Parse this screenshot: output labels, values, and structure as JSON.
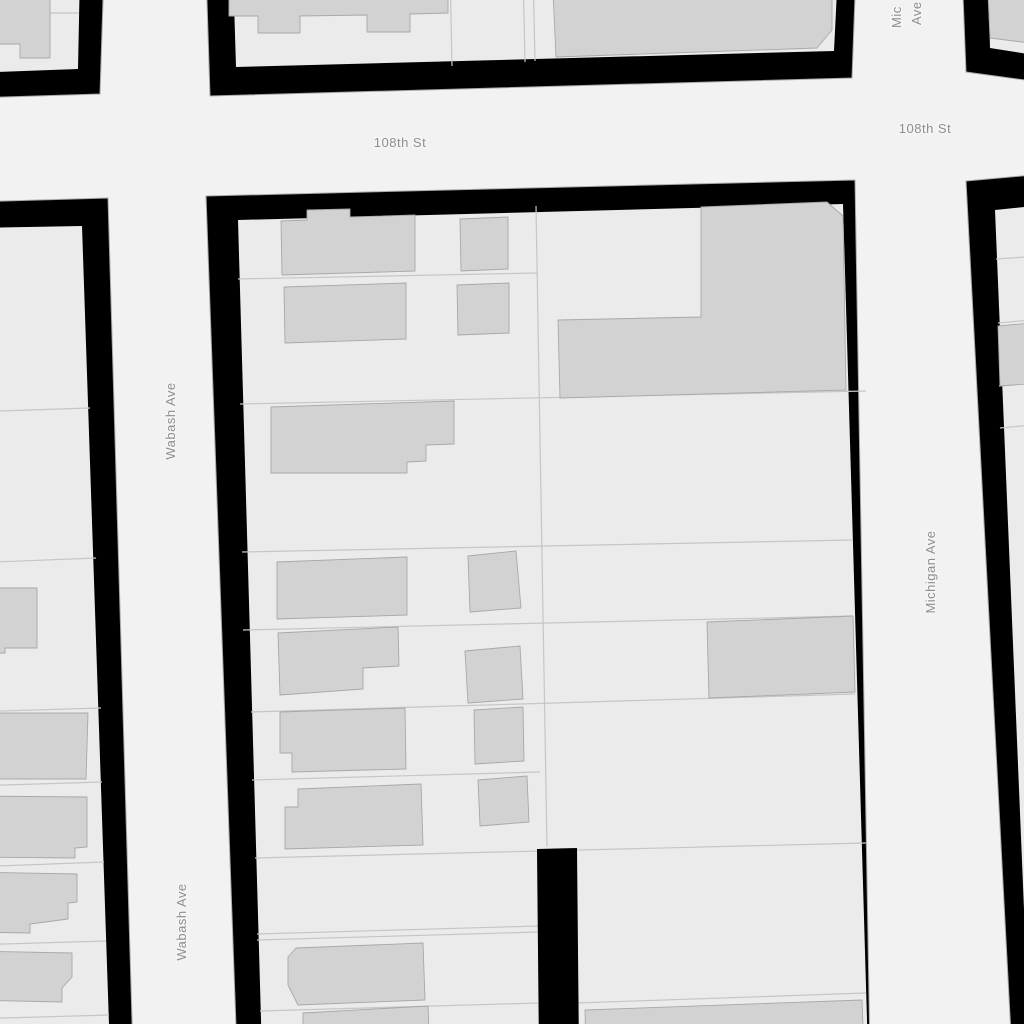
{
  "map": {
    "colors": {
      "street": "#f2f2f2",
      "block_fill": "#ebebeb",
      "block_border": "#000000",
      "block_outline": "#a9a9a9",
      "building_fill": "#d2d2d2",
      "building_stroke": "#a8a8a8",
      "parcel_line": "#c6c6c6",
      "label": "#8f8f8f",
      "label_halo": "#f5f5f5"
    },
    "labels": [
      {
        "name": "street-label-108th-st-west",
        "text": "108th St",
        "x": 400,
        "y": 147,
        "rotate": 0,
        "anchor": "middle"
      },
      {
        "name": "street-label-108th-st-east",
        "text": "108th St",
        "x": 925,
        "y": 133,
        "rotate": 0,
        "anchor": "middle"
      },
      {
        "name": "street-label-wabash-ave-north",
        "text": "Wabash Ave",
        "x": 175,
        "y": 421,
        "rotate": -90,
        "anchor": "middle"
      },
      {
        "name": "street-label-wabash-ave-south",
        "text": "Wabash Ave",
        "x": 186,
        "y": 922,
        "rotate": -90,
        "anchor": "middle"
      },
      {
        "name": "street-label-michigan-ave",
        "text": "Michigan Ave",
        "x": 935,
        "y": 572,
        "rotate": -90,
        "anchor": "middle"
      },
      {
        "name": "street-label-michigan-ave-top-line1",
        "text": "Mic",
        "x": 901,
        "y": 28,
        "rotate": -90,
        "anchor": "start"
      },
      {
        "name": "street-label-michigan-ave-top-line2",
        "text": "Ave",
        "x": 921,
        "y": 25,
        "rotate": -90,
        "anchor": "start"
      }
    ],
    "blocks": [
      {
        "name": "block-northwest",
        "outer": [
          [
            -30,
            -30
          ],
          [
            104,
            -30
          ],
          [
            100,
            94
          ],
          [
            -30,
            98
          ]
        ],
        "inner": [
          [
            -30,
            -30
          ],
          [
            80,
            -30
          ],
          [
            78,
            69
          ],
          [
            -30,
            73
          ]
        ],
        "parcel_lines": [
          [
            50,
            13,
            79,
            13
          ]
        ],
        "buildings": [
          [
            [
              -30,
              -30
            ],
            [
              50,
              -30
            ],
            [
              50,
              58
            ],
            [
              20,
              58
            ],
            [
              20,
              44
            ],
            [
              -30,
              44
            ]
          ]
        ]
      },
      {
        "name": "block-north",
        "outer": [
          [
            206,
            -30
          ],
          [
            856,
            -30
          ],
          [
            852,
            78
          ],
          [
            210,
            96
          ]
        ],
        "inner": [
          [
            233,
            -30
          ],
          [
            838,
            -30
          ],
          [
            834,
            51
          ],
          [
            236,
            67
          ]
        ],
        "parcel_lines": [
          [
            450,
            -30,
            452,
            66
          ],
          [
            523,
            -30,
            525,
            62
          ],
          [
            533,
            -30,
            535,
            61
          ]
        ],
        "buildings": [
          [
            [
              229,
              -30
            ],
            [
              448,
              -30
            ],
            [
              448,
              13
            ],
            [
              410,
              14
            ],
            [
              410,
              32
            ],
            [
              367,
              32
            ],
            [
              367,
              15
            ],
            [
              300,
              16
            ],
            [
              300,
              33
            ],
            [
              258,
              33
            ],
            [
              258,
              16
            ],
            [
              229,
              16
            ]
          ],
          [
            [
              552,
              -30
            ],
            [
              832,
              -30
            ],
            [
              832,
              30
            ],
            [
              817,
              48
            ],
            [
              556,
              57
            ]
          ]
        ]
      },
      {
        "name": "block-northeast",
        "outer": [
          [
            962,
            -30
          ],
          [
            1054,
            -30
          ],
          [
            1054,
            84
          ],
          [
            966,
            72
          ]
        ],
        "inner": [
          [
            988,
            -30
          ],
          [
            1054,
            -30
          ],
          [
            1054,
            58
          ],
          [
            990,
            48
          ]
        ],
        "parcel_lines": [],
        "buildings": [
          [
            [
              987,
              -30
            ],
            [
              1054,
              -30
            ],
            [
              1054,
              46
            ],
            [
              990,
              38
            ]
          ]
        ]
      },
      {
        "name": "block-east",
        "outer": [
          [
            966,
            181
          ],
          [
            1054,
            173
          ],
          [
            1054,
            1054
          ],
          [
            1012,
            1054
          ]
        ],
        "inner": [
          [
            995,
            210
          ],
          [
            1054,
            204
          ],
          [
            1054,
            1054
          ],
          [
            1030,
            1054
          ]
        ],
        "parcel_lines": [
          [
            996,
            259,
            1054,
            255
          ],
          [
            998,
            323,
            1054,
            318
          ],
          [
            999,
            386,
            1054,
            381
          ],
          [
            1000,
            428,
            1054,
            423
          ]
        ],
        "buildings": [
          [
            [
              998,
              326
            ],
            [
              1054,
              321
            ],
            [
              1054,
              382
            ],
            [
              1000,
              386
            ]
          ]
        ]
      },
      {
        "name": "block-west",
        "outer": [
          [
            -30,
            202
          ],
          [
            108,
            198
          ],
          [
            133,
            1054
          ],
          [
            -30,
            1054
          ]
        ],
        "inner": [
          [
            -30,
            228
          ],
          [
            82,
            226
          ],
          [
            110,
            1054
          ],
          [
            -30,
            1054
          ]
        ],
        "parcel_lines": [
          [
            -30,
            412,
            90,
            408
          ],
          [
            -30,
            563,
            96,
            558
          ],
          [
            -30,
            712,
            101,
            708
          ],
          [
            -30,
            786,
            102,
            782
          ],
          [
            -30,
            867,
            104,
            862
          ],
          [
            -30,
            945,
            106,
            941
          ],
          [
            -30,
            1019,
            109,
            1015
          ]
        ],
        "buildings": [
          [
            [
              -30,
              588
            ],
            [
              37,
              588
            ],
            [
              37,
              648
            ],
            [
              5,
              648
            ],
            [
              5,
              653
            ],
            [
              -30,
              653
            ]
          ],
          [
            [
              -30,
              713
            ],
            [
              88,
              713
            ],
            [
              86,
              779
            ],
            [
              -30,
              779
            ]
          ],
          [
            [
              -30,
              796
            ],
            [
              87,
              797
            ],
            [
              87,
              847
            ],
            [
              75,
              848
            ],
            [
              75,
              858
            ],
            [
              -30,
              857
            ]
          ],
          [
            [
              -30,
              872
            ],
            [
              77,
              874
            ],
            [
              77,
              902
            ],
            [
              68,
              903
            ],
            [
              68,
              919
            ],
            [
              30,
              924
            ],
            [
              30,
              933
            ],
            [
              -30,
              932
            ]
          ],
          [
            [
              -30,
              951
            ],
            [
              72,
              953
            ],
            [
              72,
              977
            ],
            [
              62,
              988
            ],
            [
              62,
              1002
            ],
            [
              -30,
              1000
            ]
          ]
        ]
      },
      {
        "name": "block-center",
        "outer": [
          [
            206,
            196
          ],
          [
            855,
            180
          ],
          [
            870,
            1054
          ],
          [
            237,
            1054
          ]
        ],
        "inner": [
          [
            238,
            220
          ],
          [
            843,
            204
          ],
          [
            868,
            1054
          ],
          [
            262,
            1054
          ]
        ],
        "parcel_lines": [
          [
            238,
            279,
            537,
            273
          ],
          [
            240,
            404,
            866,
            391
          ],
          [
            242,
            552,
            852,
            540
          ],
          [
            243,
            630,
            852,
            616
          ],
          [
            251,
            712,
            855,
            694
          ],
          [
            252,
            780,
            540,
            772
          ],
          [
            255,
            858,
            866,
            843
          ],
          [
            257,
            934,
            538,
            926
          ],
          [
            257,
            940,
            538,
            932
          ],
          [
            260,
            1011,
            538,
            1003
          ],
          [
            577,
            1003,
            866,
            993
          ],
          [
            536,
            206,
            547,
            847
          ]
        ],
        "buildings": [
          [
            [
              281,
              221
            ],
            [
              307,
              220
            ],
            [
              307,
              210
            ],
            [
              350,
              209
            ],
            [
              350,
              217
            ],
            [
              415,
              215
            ],
            [
              415,
              271
            ],
            [
              282,
              275
            ]
          ],
          [
            [
              460,
              219
            ],
            [
              508,
              217
            ],
            [
              508,
              269
            ],
            [
              461,
              271
            ]
          ],
          [
            [
              284,
              287
            ],
            [
              406,
              283
            ],
            [
              406,
              339
            ],
            [
              285,
              343
            ]
          ],
          [
            [
              457,
              285
            ],
            [
              509,
              283
            ],
            [
              509,
              333
            ],
            [
              458,
              335
            ]
          ],
          [
            [
              271,
              407
            ],
            [
              454,
              401
            ],
            [
              454,
              444
            ],
            [
              426,
              445
            ],
            [
              426,
              461
            ],
            [
              407,
              462
            ],
            [
              407,
              473
            ],
            [
              271,
              473
            ]
          ],
          [
            [
              277,
              562
            ],
            [
              407,
              557
            ],
            [
              407,
              615
            ],
            [
              277,
              619
            ]
          ],
          [
            [
              468,
              556
            ],
            [
              516,
              551
            ],
            [
              521,
              608
            ],
            [
              470,
              612
            ]
          ],
          [
            [
              278,
              633
            ],
            [
              398,
              627
            ],
            [
              399,
              666
            ],
            [
              363,
              668
            ],
            [
              363,
              689
            ],
            [
              280,
              695
            ]
          ],
          [
            [
              465,
              651
            ],
            [
              520,
              646
            ],
            [
              523,
              699
            ],
            [
              468,
              703
            ]
          ],
          [
            [
              280,
              712
            ],
            [
              405,
              708
            ],
            [
              406,
              769
            ],
            [
              292,
              772
            ],
            [
              292,
              753
            ],
            [
              280,
              753
            ]
          ],
          [
            [
              474,
              710
            ],
            [
              523,
              707
            ],
            [
              524,
              761
            ],
            [
              475,
              764
            ]
          ],
          [
            [
              298,
              789
            ],
            [
              421,
              784
            ],
            [
              423,
              845
            ],
            [
              285,
              849
            ],
            [
              285,
              807
            ],
            [
              298,
              807
            ]
          ],
          [
            [
              478,
              780
            ],
            [
              527,
              776
            ],
            [
              529,
              822
            ],
            [
              480,
              826
            ]
          ],
          [
            [
              296,
              948
            ],
            [
              423,
              943
            ],
            [
              425,
              1000
            ],
            [
              298,
              1005
            ],
            [
              288,
              985
            ],
            [
              288,
              957
            ]
          ],
          [
            [
              303,
              1013
            ],
            [
              428,
              1006
            ],
            [
              430,
              1054
            ],
            [
              303,
              1054
            ]
          ],
          [
            [
              701,
              207
            ],
            [
              827,
              202
            ],
            [
              843,
              216
            ],
            [
              846,
              390
            ],
            [
              560,
              398
            ],
            [
              558,
              320
            ],
            [
              701,
              317
            ]
          ],
          [
            [
              707,
              622
            ],
            [
              853,
              616
            ],
            [
              855,
              692
            ],
            [
              709,
              698
            ]
          ],
          [
            [
              585,
              1010
            ],
            [
              862,
              1000
            ],
            [
              864,
              1054
            ],
            [
              586,
              1054
            ]
          ]
        ]
      }
    ],
    "alley": [
      [
        537,
        849
      ],
      [
        577,
        848
      ],
      [
        579,
        1054
      ],
      [
        539,
        1054
      ]
    ]
  }
}
